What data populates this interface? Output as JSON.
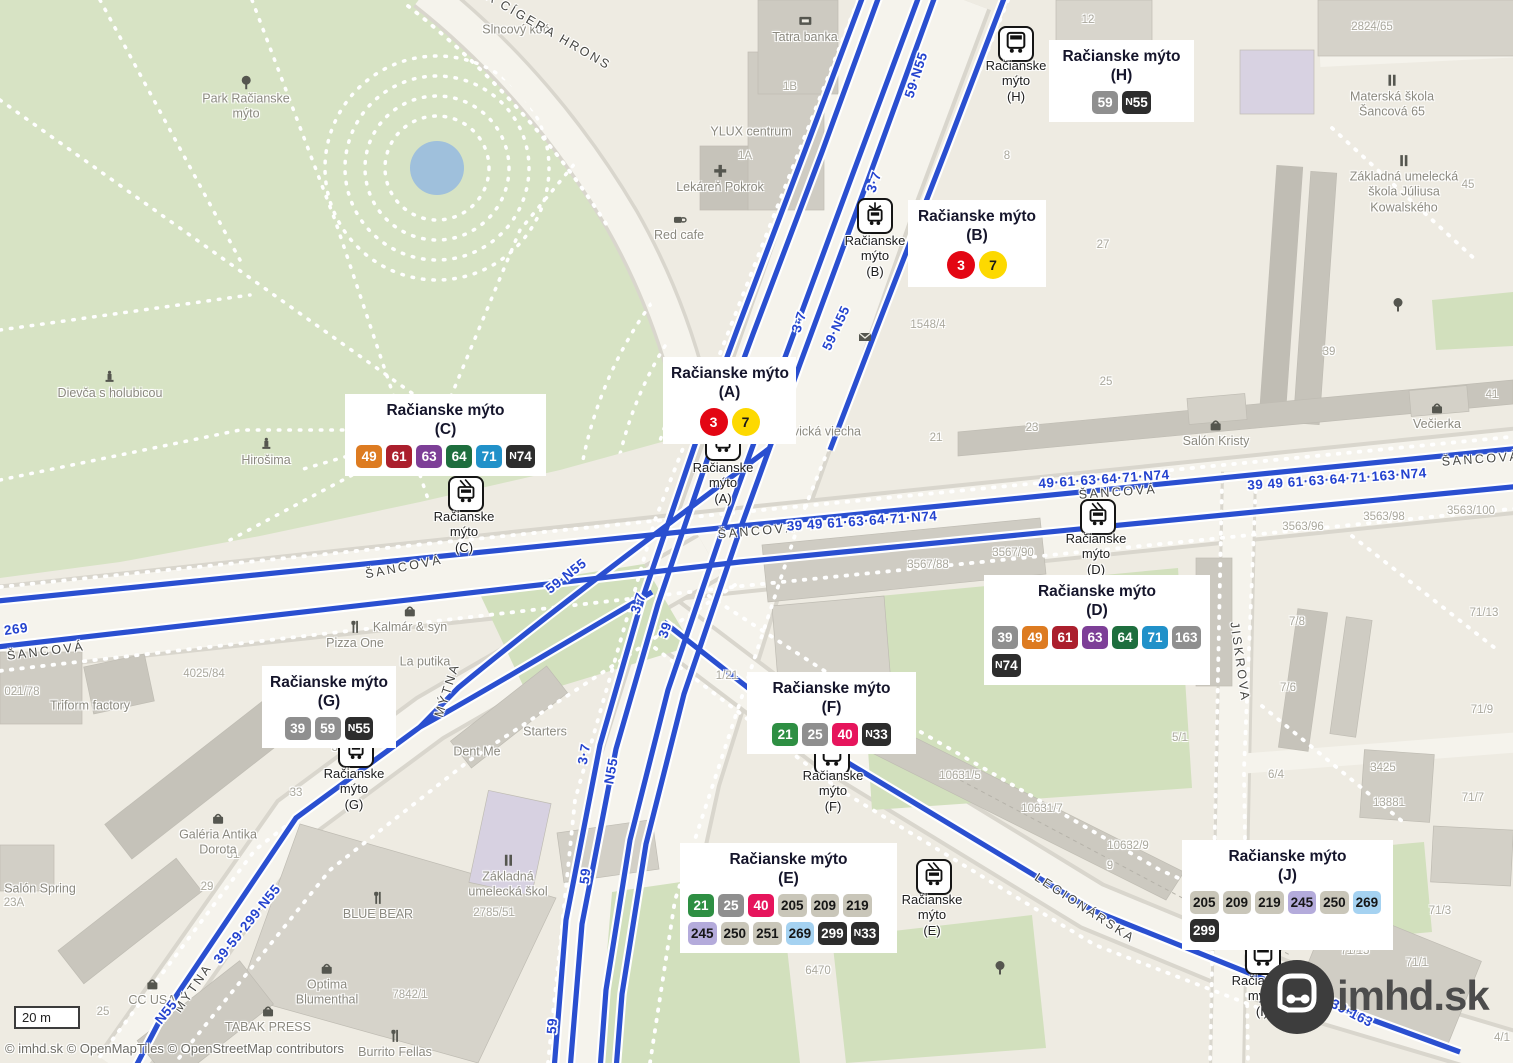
{
  "palette": {
    "3": {
      "bg": "#e30613",
      "fg": "#ffffff",
      "shape": "circle"
    },
    "7": {
      "bg": "#fdd900",
      "fg": "#1a1a1a",
      "shape": "circle"
    },
    "21": {
      "bg": "#2e8f43",
      "fg": "#ffffff"
    },
    "25": {
      "bg": "#8f8f8f",
      "fg": "#ffffff"
    },
    "39": {
      "bg": "#8f8f8f",
      "fg": "#ffffff"
    },
    "40": {
      "bg": "#e6155c",
      "fg": "#ffffff"
    },
    "49": {
      "bg": "#dd7b21",
      "fg": "#ffffff"
    },
    "59": {
      "bg": "#8f8f8f",
      "fg": "#ffffff"
    },
    "61": {
      "bg": "#ab1f2d",
      "fg": "#ffffff"
    },
    "63": {
      "bg": "#7d3f97",
      "fg": "#ffffff"
    },
    "64": {
      "bg": "#1e6e3e",
      "fg": "#ffffff"
    },
    "71": {
      "bg": "#2191c9",
      "fg": "#ffffff"
    },
    "163": {
      "bg": "#8f8f8f",
      "fg": "#ffffff"
    },
    "205": {
      "bg": "#c9c6b9",
      "fg": "#161616"
    },
    "209": {
      "bg": "#c9c6b9",
      "fg": "#161616"
    },
    "219": {
      "bg": "#c9c6b9",
      "fg": "#161616"
    },
    "245": {
      "bg": "#b4abdb",
      "fg": "#161616"
    },
    "250": {
      "bg": "#c9c6b9",
      "fg": "#161616"
    },
    "251": {
      "bg": "#c9c6b9",
      "fg": "#161616"
    },
    "269": {
      "bg": "#a5d2f1",
      "fg": "#161616"
    },
    "299": {
      "bg": "#2d2d2d",
      "fg": "#ffffff"
    },
    "N33": {
      "bg": "#2d2d2d",
      "fg": "#ffffff"
    },
    "N55": {
      "bg": "#2d2d2d",
      "fg": "#ffffff"
    },
    "N74": {
      "bg": "#2d2d2d",
      "fg": "#ffffff"
    }
  },
  "callouts": [
    {
      "id": "H",
      "x": 1049,
      "y": 40,
      "w": 145,
      "title": "Račianske mýto",
      "sub": "(H)",
      "align": "center",
      "rows": [
        [
          "59",
          "N55"
        ]
      ]
    },
    {
      "id": "B",
      "x": 908,
      "y": 200,
      "w": 138,
      "title": "Račianske mýto",
      "sub": "(B)",
      "align": "center",
      "rows": [
        [
          "3",
          "7"
        ]
      ]
    },
    {
      "id": "A",
      "x": 663,
      "y": 357,
      "w": 133,
      "title": "Račianske mýto",
      "sub": "(A)",
      "align": "center",
      "rows": [
        [
          "3",
          "7"
        ]
      ]
    },
    {
      "id": "C",
      "x": 345,
      "y": 394,
      "w": 201,
      "title": "Račianske mýto",
      "sub": "(C)",
      "align": "center",
      "rows": [
        [
          "49",
          "61",
          "63",
          "64",
          "71",
          "N74"
        ]
      ]
    },
    {
      "id": "D",
      "x": 984,
      "y": 575,
      "w": 226,
      "title": "Račianske mýto",
      "sub": "(D)",
      "align": "left",
      "rows": [
        [
          "39",
          "49",
          "61",
          "63",
          "64",
          "71",
          "163"
        ],
        [
          "N74"
        ]
      ]
    },
    {
      "id": "G",
      "x": 262,
      "y": 666,
      "w": 134,
      "title": "Račianske mýto",
      "sub": "(G)",
      "align": "center",
      "rows": [
        [
          "39",
          "59",
          "N55"
        ]
      ]
    },
    {
      "id": "F",
      "x": 747,
      "y": 672,
      "w": 169,
      "title": "Račianske mýto",
      "sub": "(F)",
      "align": "center",
      "rows": [
        [
          "21",
          "25",
          "40",
          "N33"
        ]
      ]
    },
    {
      "id": "E",
      "x": 680,
      "y": 843,
      "w": 217,
      "title": "Račianske mýto",
      "sub": "(E)",
      "align": "left",
      "rows": [
        [
          "21",
          "25",
          "40",
          "205",
          "209",
          "219"
        ],
        [
          "245",
          "250",
          "251",
          "269",
          "299",
          "N33"
        ]
      ]
    },
    {
      "id": "J",
      "x": 1182,
      "y": 840,
      "w": 211,
      "title": "Račianske mýto",
      "sub": "(J)",
      "align": "left",
      "rows": [
        [
          "205",
          "209",
          "219",
          "245",
          "250",
          "269"
        ],
        [
          "299"
        ]
      ]
    }
  ],
  "stops": [
    {
      "id": "H",
      "type": "bus",
      "x": 1016,
      "y": 44,
      "lx": 1016,
      "ly": 81,
      "lines": [
        "Račianske",
        "mýto",
        "(H)"
      ]
    },
    {
      "id": "B",
      "type": "tram",
      "x": 875,
      "y": 216,
      "lx": 875,
      "ly": 256,
      "lines": [
        "Račianske",
        "mýto",
        "(B)"
      ]
    },
    {
      "id": "A",
      "type": "tram",
      "x": 723,
      "y": 443,
      "lx": 723,
      "ly": 483,
      "lines": [
        "Račianske",
        "mýto",
        "(A)"
      ]
    },
    {
      "id": "C",
      "type": "trolleybus",
      "x": 466,
      "y": 494,
      "lx": 464,
      "ly": 532,
      "lines": [
        "Račianske",
        "mýto",
        "(C)"
      ]
    },
    {
      "id": "D",
      "type": "trolleybus",
      "x": 1098,
      "y": 517,
      "lx": 1096,
      "ly": 554,
      "lines": [
        "Račianske",
        "mýto",
        "(D)"
      ]
    },
    {
      "id": "G",
      "type": "tram",
      "x": 356,
      "y": 750,
      "lx": 354,
      "ly": 789,
      "lines": [
        "Račianske",
        "mýto",
        "(G)"
      ]
    },
    {
      "id": "F",
      "type": "bus",
      "x": 832,
      "y": 757,
      "lx": 833,
      "ly": 791,
      "lines": [
        "Račianske",
        "mýto",
        "(F)"
      ]
    },
    {
      "id": "E",
      "type": "trolleybus",
      "x": 934,
      "y": 877,
      "lx": 932,
      "ly": 915,
      "lines": [
        "Račianske",
        "mýto",
        "(E)"
      ]
    },
    {
      "id": "I",
      "type": "bus",
      "x": 1263,
      "y": 957,
      "lx": 1262,
      "ly": 996,
      "lines": [
        "Račianske",
        "mýto",
        "(I)"
      ]
    }
  ],
  "street_labels": [
    {
      "t": "ŠANCOVÁ",
      "x": 46,
      "y": 651,
      "r": -7
    },
    {
      "t": "ŠANCOVÁ",
      "x": 404,
      "y": 567,
      "r": -11
    },
    {
      "t": "ŠANCOVÁ",
      "x": 757,
      "y": 531,
      "r": -5
    },
    {
      "t": "ŠANCOVÁ",
      "x": 1118,
      "y": 492,
      "r": -4
    },
    {
      "t": "ŠANCOVÁ",
      "x": 1481,
      "y": 459,
      "r": -4
    },
    {
      "t": "MÝTNA",
      "x": 447,
      "y": 690,
      "r": -72
    },
    {
      "t": "MÝTNA",
      "x": 193,
      "y": 988,
      "r": -55
    },
    {
      "t": "LEGIONÁRSKA",
      "x": 1085,
      "y": 908,
      "r": 33
    },
    {
      "t": "JISKROVA",
      "x": 1240,
      "y": 662,
      "r": 82
    },
    {
      "t": "EFA CÍGERA HRONS",
      "x": 540,
      "y": 26,
      "r": 30
    }
  ],
  "route_labels": [
    {
      "t": "59·N55",
      "x": 916,
      "y": 75,
      "r": -72
    },
    {
      "t": "3·7",
      "x": 874,
      "y": 182,
      "r": -72
    },
    {
      "t": "3·7",
      "x": 799,
      "y": 322,
      "r": -72
    },
    {
      "t": "59·N55",
      "x": 836,
      "y": 328,
      "r": -65
    },
    {
      "t": "59·N55",
      "x": 566,
      "y": 576,
      "r": -38
    },
    {
      "t": "3·7",
      "x": 638,
      "y": 603,
      "r": -72
    },
    {
      "t": "39",
      "x": 665,
      "y": 630,
      "r": -72
    },
    {
      "t": "3·7",
      "x": 584,
      "y": 754,
      "r": -80
    },
    {
      "t": "N55",
      "x": 611,
      "y": 771,
      "r": -80
    },
    {
      "t": "59",
      "x": 585,
      "y": 876,
      "r": -84
    },
    {
      "t": "59",
      "x": 552,
      "y": 1026,
      "r": -86
    },
    {
      "t": "39·59·299·N55",
      "x": 247,
      "y": 924,
      "r": -51
    },
    {
      "t": "N55",
      "x": 166,
      "y": 1012,
      "r": -51
    },
    {
      "t": "269",
      "x": 16,
      "y": 629,
      "r": -8
    },
    {
      "t": "39 49 61·63·64·71·N74",
      "x": 862,
      "y": 521,
      "r": -4
    },
    {
      "t": "49·61·63·64·71·N74",
      "x": 1104,
      "y": 479,
      "r": -4
    },
    {
      "t": "39 49 61·63·64·71·163·N74",
      "x": 1337,
      "y": 479,
      "r": -4
    },
    {
      "t": "39·163",
      "x": 1352,
      "y": 1013,
      "r": 27
    }
  ],
  "pois": [
    {
      "t": "Slncový kôň",
      "x": 516,
      "y": 30
    },
    {
      "t": "Park Račianske\nmýto",
      "x": 246,
      "y": 98,
      "icon": "tree"
    },
    {
      "t": "Dievča s holubicou",
      "x": 110,
      "y": 385,
      "icon": "monument"
    },
    {
      "t": "Hirošima",
      "x": 266,
      "y": 452,
      "icon": "monument"
    },
    {
      "t": "Tatra banka",
      "x": 805,
      "y": 29,
      "icon": "atm"
    },
    {
      "t": "YLUX centrum",
      "x": 751,
      "y": 132
    },
    {
      "t": "Lekáreň Pokrok",
      "x": 720,
      "y": 179,
      "icon": "cross"
    },
    {
      "t": "Red cafe",
      "x": 679,
      "y": 227,
      "icon": "cafe"
    },
    {
      "t": "Levická viecha",
      "x": 820,
      "y": 432
    },
    {
      "t": "Salón Kristy",
      "x": 1216,
      "y": 433,
      "icon": "shop"
    },
    {
      "t": "Večierka",
      "x": 1437,
      "y": 416,
      "icon": "shop"
    },
    {
      "t": "Materská škola\nŠancová 65",
      "x": 1392,
      "y": 96,
      "icon": "school"
    },
    {
      "t": "Základná umelecká\nškola Júliusa\nKowalského",
      "x": 1404,
      "y": 184,
      "icon": "school"
    },
    {
      "t": "Kalmár & syn",
      "x": 410,
      "y": 619,
      "icon": "shop"
    },
    {
      "t": "Pizza One",
      "x": 355,
      "y": 635,
      "icon": "restaurant"
    },
    {
      "t": "La putika",
      "x": 425,
      "y": 662
    },
    {
      "t": "Dent Me",
      "x": 477,
      "y": 752
    },
    {
      "t": "Starters",
      "x": 545,
      "y": 732
    },
    {
      "t": "Triform factory",
      "x": 90,
      "y": 706
    },
    {
      "t": "Galéria Antika\nDorota",
      "x": 218,
      "y": 834,
      "icon": "shop"
    },
    {
      "t": "Salón Spring",
      "x": 40,
      "y": 889
    },
    {
      "t": "CC USA",
      "x": 152,
      "y": 992,
      "icon": "shop"
    },
    {
      "t": "Optima\nBlumenthal",
      "x": 327,
      "y": 984,
      "icon": "shop"
    },
    {
      "t": "TABAK PRESS",
      "x": 268,
      "y": 1019,
      "icon": "shop"
    },
    {
      "t": "Burrito Fellas",
      "x": 395,
      "y": 1044,
      "icon": "restaurant"
    },
    {
      "t": "BLUE BEAR",
      "x": 378,
      "y": 906,
      "icon": "restaurant"
    },
    {
      "t": "Základná\numelecká škol",
      "x": 508,
      "y": 876,
      "icon": "school"
    },
    {
      "t": "",
      "x": 1000,
      "y": 968,
      "icon": "tree"
    },
    {
      "t": "",
      "x": 1398,
      "y": 305,
      "icon": "tree"
    },
    {
      "t": "",
      "x": 865,
      "y": 337,
      "icon": "post"
    }
  ],
  "parcels": [
    {
      "t": "12",
      "x": 1088,
      "y": 20
    },
    {
      "t": "2824/65",
      "x": 1372,
      "y": 27
    },
    {
      "t": "1B",
      "x": 790,
      "y": 87
    },
    {
      "t": "1A",
      "x": 745,
      "y": 156
    },
    {
      "t": "8",
      "x": 1007,
      "y": 156
    },
    {
      "t": "45",
      "x": 1468,
      "y": 185
    },
    {
      "t": "27",
      "x": 1103,
      "y": 245
    },
    {
      "t": "1548/4",
      "x": 928,
      "y": 325
    },
    {
      "t": "39",
      "x": 1329,
      "y": 352
    },
    {
      "t": "25",
      "x": 1106,
      "y": 382
    },
    {
      "t": "23",
      "x": 1032,
      "y": 428
    },
    {
      "t": "21",
      "x": 936,
      "y": 438
    },
    {
      "t": "41",
      "x": 1492,
      "y": 395
    },
    {
      "t": "3563/96",
      "x": 1303,
      "y": 527
    },
    {
      "t": "3563/98",
      "x": 1384,
      "y": 517
    },
    {
      "t": "3563/100",
      "x": 1471,
      "y": 511
    },
    {
      "t": "3567/88",
      "x": 928,
      "y": 565
    },
    {
      "t": "3567/90",
      "x": 1013,
      "y": 553
    },
    {
      "t": "71/13",
      "x": 1484,
      "y": 613
    },
    {
      "t": "7/8",
      "x": 1297,
      "y": 622
    },
    {
      "t": "7/6",
      "x": 1288,
      "y": 688
    },
    {
      "t": "71/9",
      "x": 1482,
      "y": 710
    },
    {
      "t": "6/4",
      "x": 1276,
      "y": 775
    },
    {
      "t": "3425",
      "x": 1383,
      "y": 768
    },
    {
      "t": "13881",
      "x": 1389,
      "y": 803
    },
    {
      "t": "71/7",
      "x": 1473,
      "y": 798
    },
    {
      "t": "1/21",
      "x": 727,
      "y": 676
    },
    {
      "t": "4025/84",
      "x": 204,
      "y": 674
    },
    {
      "t": "021/78",
      "x": 22,
      "y": 692
    },
    {
      "t": "35",
      "x": 338,
      "y": 748
    },
    {
      "t": "33",
      "x": 296,
      "y": 793
    },
    {
      "t": "31",
      "x": 233,
      "y": 855
    },
    {
      "t": "29",
      "x": 207,
      "y": 887
    },
    {
      "t": "23A",
      "x": 14,
      "y": 903
    },
    {
      "t": "25",
      "x": 103,
      "y": 1012
    },
    {
      "t": "5/1",
      "x": 1180,
      "y": 738
    },
    {
      "t": "10631/5",
      "x": 960,
      "y": 776
    },
    {
      "t": "10631/7",
      "x": 1042,
      "y": 809
    },
    {
      "t": "10632/9",
      "x": 1128,
      "y": 846
    },
    {
      "t": "9",
      "x": 1110,
      "y": 866
    },
    {
      "t": "6470",
      "x": 818,
      "y": 971
    },
    {
      "t": "2785/51",
      "x": 494,
      "y": 913
    },
    {
      "t": "7842/1",
      "x": 410,
      "y": 995
    },
    {
      "t": "71/15",
      "x": 1355,
      "y": 951
    },
    {
      "t": "71/1",
      "x": 1417,
      "y": 963
    },
    {
      "t": "71/3",
      "x": 1440,
      "y": 911
    },
    {
      "t": "4/1",
      "x": 1502,
      "y": 1038
    }
  ],
  "scale_bar": {
    "label": "20 m"
  },
  "attribution": {
    "text": "© imhd.sk © OpenMapTiles © OpenStreetMap contributors"
  },
  "logo": {
    "text": "imhd.sk"
  }
}
